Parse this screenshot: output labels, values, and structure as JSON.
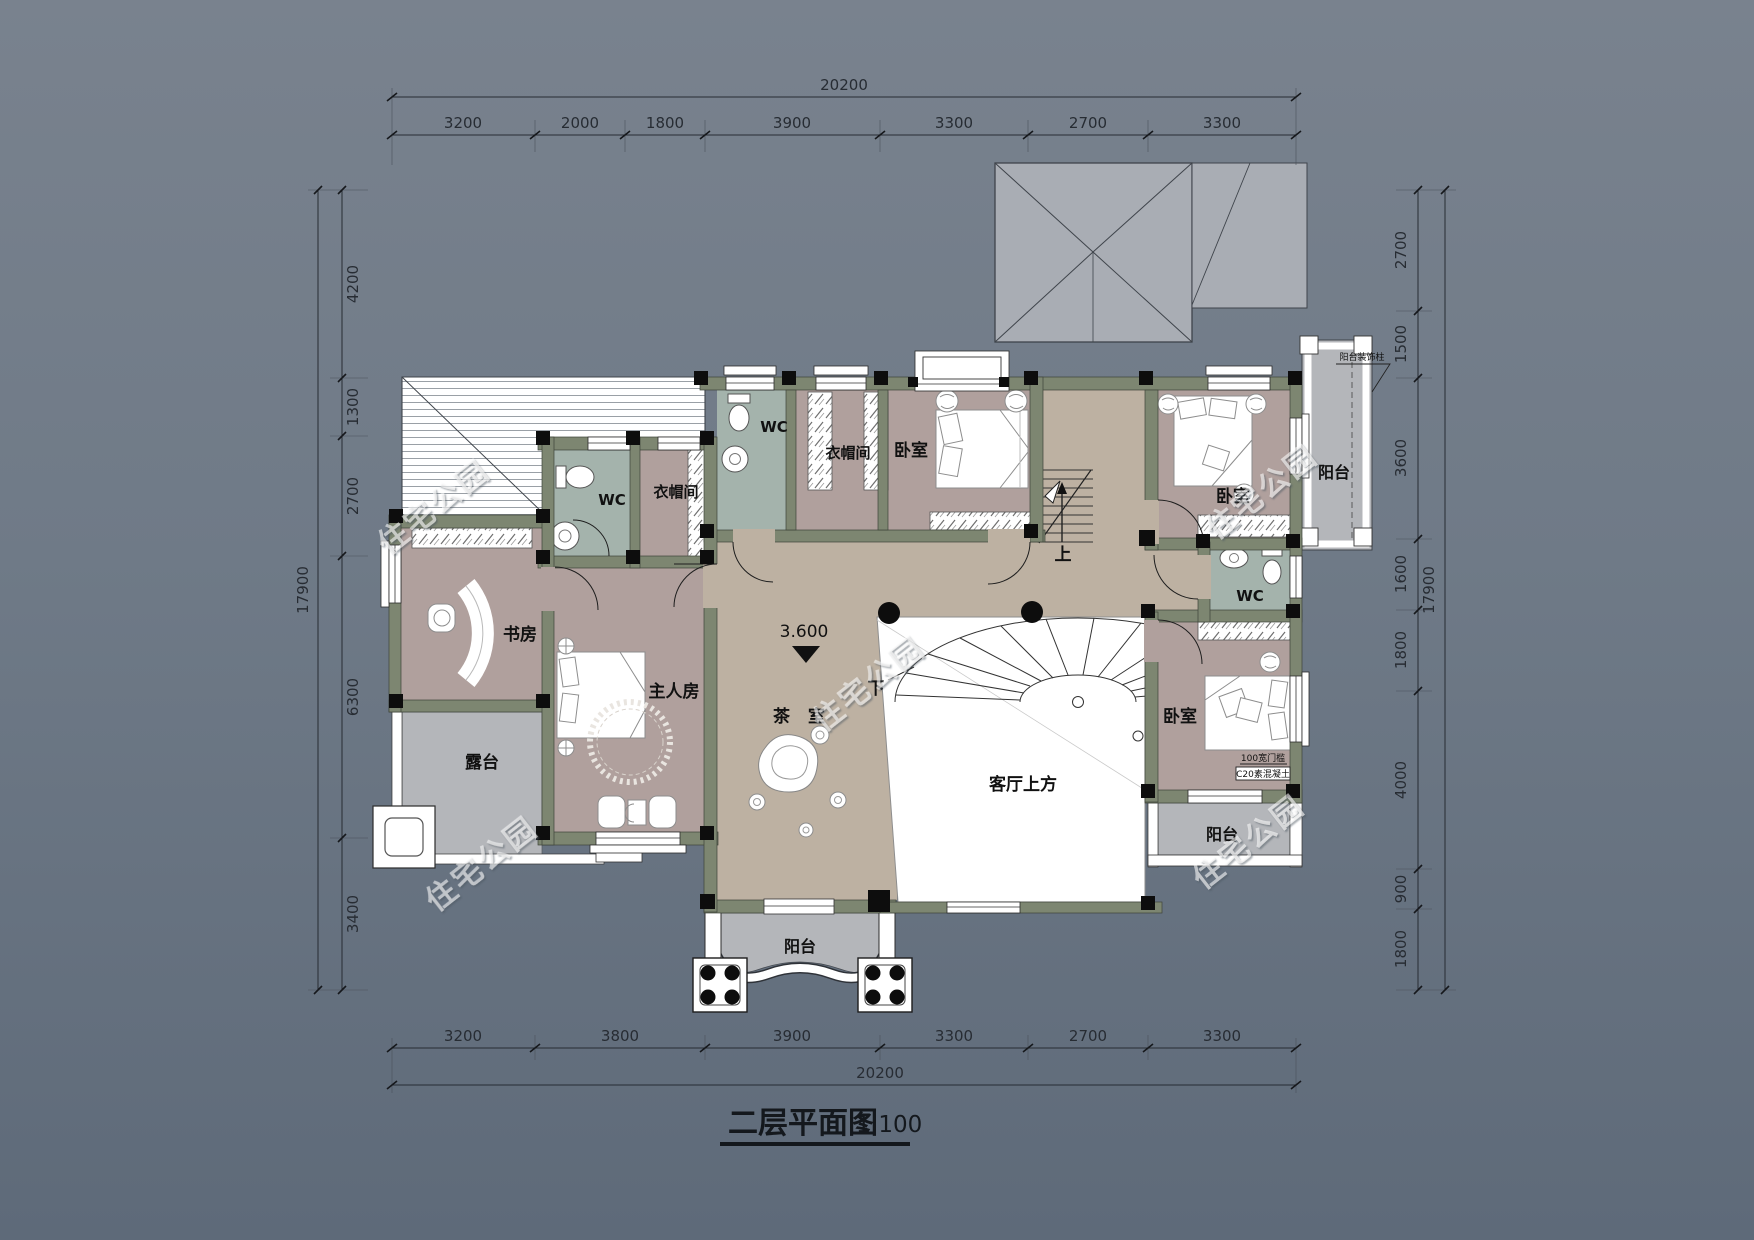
{
  "title": {
    "name": "二层平面图",
    "scale": "1:100"
  },
  "watermark": "住宅公园",
  "rooms": {
    "study": "书房",
    "terrace": "露台",
    "master": "主人房",
    "tea": "茶 室",
    "living_void": "客厅上方",
    "wc": "WC",
    "cloak": "衣帽间",
    "bedroom": "卧室",
    "balcony": "阳台"
  },
  "stairs": {
    "up": "上",
    "down": "下",
    "level": "3.600"
  },
  "annotations": {
    "balcony_column": "阳台装饰柱",
    "threshold": "100宽门槛",
    "concrete": "C20素混凝土"
  },
  "dimensions": {
    "top": {
      "total": "20200",
      "segments": [
        "3200",
        "2000",
        "1800",
        "3900",
        "3300",
        "2700",
        "3300"
      ]
    },
    "bottom": {
      "total": "20200",
      "segments": [
        "3200",
        "3800",
        "3900",
        "3300",
        "2700",
        "3300"
      ]
    },
    "left": {
      "total": "17900",
      "segments": [
        "4200",
        "1300",
        "2700",
        "6300",
        "3400"
      ]
    },
    "right": {
      "total": "17900",
      "segments": [
        "2700",
        "1500",
        "3600",
        "1600",
        "1800",
        "4000",
        "900",
        "1800"
      ]
    }
  },
  "colors": {
    "background_top": "#79828e",
    "background_bottom": "#5e6a79",
    "wall": "#7d8671",
    "room_mauve": "#b0a09d",
    "hall_tan": "#bdb1a2",
    "wc_sage": "#a4b3ac",
    "balcony_gray": "#b4b6ba",
    "roof_gray": "#a9adb4",
    "dim_text": "#272c33"
  }
}
